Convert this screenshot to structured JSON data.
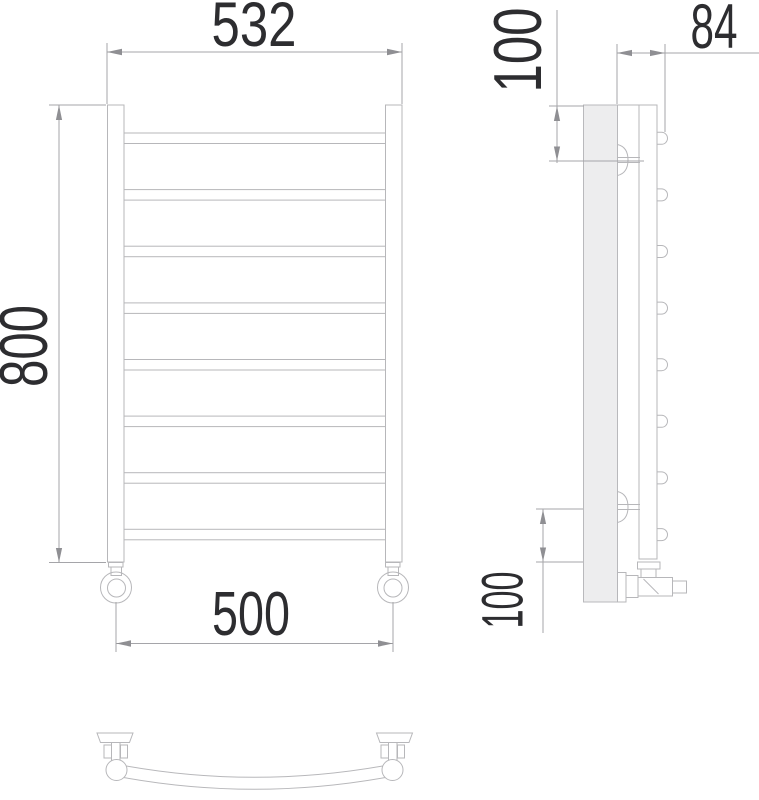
{
  "drawing": {
    "kind": "heated towel rail technical drawing",
    "dimensions": {
      "overall_width": "532",
      "height": "800",
      "mounting_width": "500",
      "depth": "84",
      "top_offset": "100",
      "bottom_offset": "100"
    },
    "views": {
      "front": {
        "rungs": 8,
        "posts": 2,
        "feet": 2
      },
      "side": {
        "rung_ends": 8,
        "wall_brackets": 2,
        "valve": 1
      },
      "bottom": {
        "curved_rung": 1,
        "wall_brackets": 2
      }
    },
    "colors": {
      "background": "#ffffff",
      "object_line": "#b7b7ba",
      "dimension_line": "#a5a5a9",
      "text": "#2d2d30",
      "plate_fill": "#ededee"
    }
  }
}
